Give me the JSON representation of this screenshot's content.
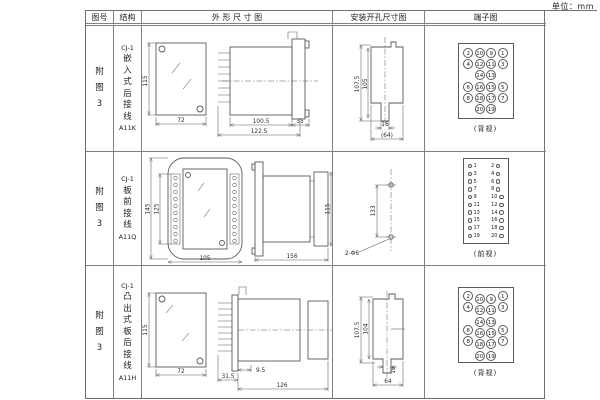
{
  "unit_label": "单位：mm",
  "colors": {
    "background": "#ffffff",
    "line": "#707070",
    "drawing_line": "#5a5a5a",
    "text": "#1a1a1a"
  },
  "header": {
    "col_fig": "图号",
    "col_structure": "结构",
    "col_outline": "外 形 尺 寸 图",
    "col_mounting": "安装开孔尺寸图",
    "col_terminal": "端子图"
  },
  "rows": [
    {
      "fig_lines": [
        "附",
        "图",
        "3"
      ],
      "structure_lines": [
        "CJ-1",
        "嵌",
        "入",
        "式",
        "后",
        "接",
        "线",
        "A11K"
      ],
      "outline": {
        "front_height": "115",
        "front_width": "72",
        "body_depth": "100.5",
        "total_depth": "122.5",
        "flange_width": "35"
      },
      "mounting": {
        "outer_height": "107.5",
        "inner_height": "105",
        "slot_width": "16",
        "cutout_width": "(64)"
      },
      "terminal": {
        "caption": "(背视)",
        "cells": [
          "2",
          "10",
          "9",
          "1",
          "4",
          "12",
          "11",
          "3",
          "",
          "14",
          "13",
          "",
          "6",
          "16",
          "15",
          "5",
          "8",
          "18",
          "17",
          "7",
          "",
          "20",
          "19",
          ""
        ]
      }
    },
    {
      "fig_lines": [
        "附",
        "图",
        "3"
      ],
      "structure_lines": [
        "CJ-1",
        "板",
        "前",
        "接",
        "线",
        "A11Q"
      ],
      "outline": {
        "front_total_height": "145",
        "front_hole_height": "125",
        "front_width": "105",
        "body_length": "156",
        "body_height": "115"
      },
      "mounting": {
        "hole_spacing": "133",
        "hole_note": "2-Φ6"
      },
      "terminal": {
        "caption": "(前视)",
        "left": [
          "1",
          "3",
          "5",
          "7",
          "9",
          "11",
          "13",
          "15",
          "17",
          "19"
        ],
        "right": [
          "2",
          "4",
          "6",
          "8",
          "10",
          "12",
          "14",
          "16",
          "18",
          "20"
        ]
      }
    },
    {
      "fig_lines": [
        "附",
        "图",
        "3"
      ],
      "structure_lines": [
        "CJ-1",
        "凸",
        "出",
        "式",
        "板",
        "后",
        "接",
        "线",
        "A11H"
      ],
      "outline": {
        "front_height": "115",
        "front_width": "72",
        "stud_depth": "9.5",
        "pin_depth": "31.5",
        "body_depth": "126"
      },
      "mounting": {
        "outer_height": "107.5",
        "inner_height": "104",
        "slot_width": "16",
        "cutout_width": "64"
      },
      "terminal": {
        "caption": "(背视)",
        "cells": [
          "2",
          "10",
          "9",
          "1",
          "4",
          "12",
          "11",
          "3",
          "",
          "14",
          "13",
          "",
          "6",
          "16",
          "15",
          "5",
          "8",
          "18",
          "17",
          "7",
          "",
          "20",
          "19",
          ""
        ]
      }
    }
  ]
}
